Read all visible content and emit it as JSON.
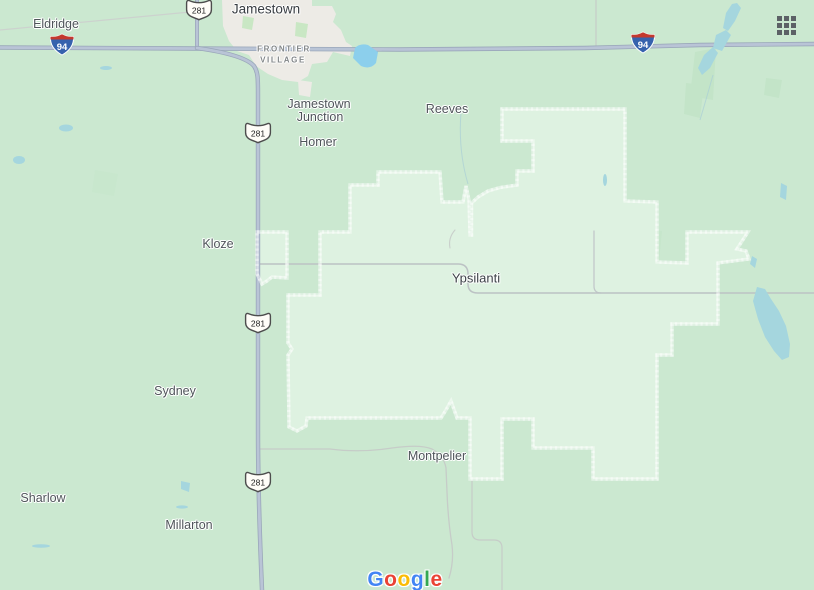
{
  "app": {
    "name": "Google Maps",
    "logo_text": "Google"
  },
  "region": {
    "name": "Ypsilanti",
    "boundary_style": "dotted-red"
  },
  "labels": {
    "eldridge": "Eldridge",
    "jamestown": "Jamestown",
    "frontier_line1": "FRONTIER",
    "frontier_line2": "VILLAGE",
    "jamestown_junction_line1": "Jamestown",
    "jamestown_junction_line2": "Junction",
    "reeves": "Reeves",
    "homer": "Homer",
    "kloze": "Kloze",
    "ypsilanti": "Ypsilanti",
    "sydney": "Sydney",
    "montpelier": "Montpelier",
    "sharlow": "Sharlow",
    "millarton": "Millarton"
  },
  "shields": {
    "interstate_94": "94",
    "us_281": "281"
  },
  "logo": {
    "letters": [
      {
        "ch": "G",
        "color": "#4285F4"
      },
      {
        "ch": "o",
        "color": "#EA4335"
      },
      {
        "ch": "o",
        "color": "#FBBC05"
      },
      {
        "ch": "g",
        "color": "#4285F4"
      },
      {
        "ch": "l",
        "color": "#34A853"
      },
      {
        "ch": "e",
        "color": "#EA4335"
      }
    ]
  },
  "icons": {
    "apps_grid": "apps-grid-icon"
  },
  "colors": {
    "map_base": "#cbe8d0",
    "region_fill": "#def2e1",
    "boundary_dots": "#dc4f3c",
    "water": "#a5d6de",
    "pond_bright": "#8ccfec",
    "highway_fill": "#b9c4d6",
    "highway_casing": "#9aa7ba",
    "minor_road": "#b9bfc2",
    "urban_area": "#edebe6",
    "label_text": "#4a5055",
    "grid_icon": "#5c6166"
  }
}
